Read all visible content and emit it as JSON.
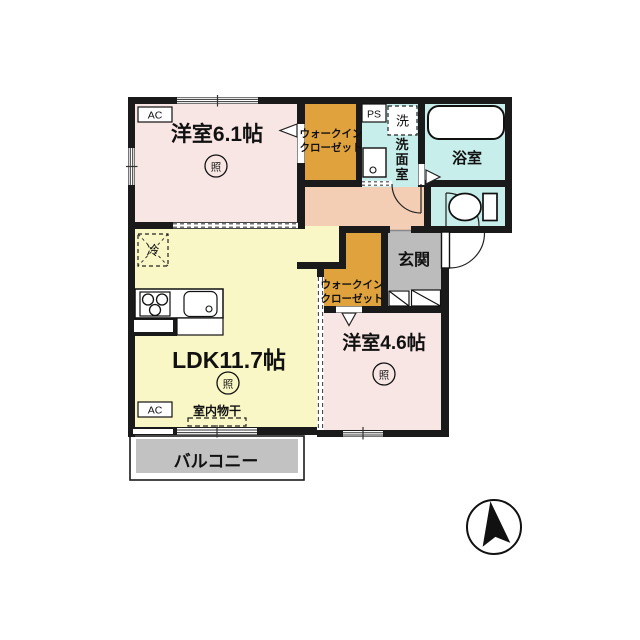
{
  "title": "apartment-floor-plan",
  "colors": {
    "wall": "#1a1a1a",
    "pink": "#f8e6e4",
    "yellow": "#faf7c6",
    "orange": "#dfa23c",
    "cyan": "#c8eeeb",
    "peach": "#f3ceb4",
    "entry_gray": "#bcbcbc",
    "balcony_gray": "#c2c2c2"
  },
  "rooms": {
    "bedroom1": {
      "label": "洋室6.1帖",
      "light": "照"
    },
    "ldk": {
      "label": "LDK11.7帖",
      "light": "照"
    },
    "bedroom2": {
      "label": "洋室4.6帖",
      "light": "照"
    },
    "wic1": {
      "line1": "ウォークイン",
      "line2": "クローゼット"
    },
    "wic2": {
      "line1": "ウォークイン",
      "line2": "クローゼット"
    },
    "washroom": {
      "char1": "洗",
      "char2": "面",
      "char3": "室"
    },
    "bath": {
      "label": "浴室"
    },
    "entrance": {
      "label": "玄関"
    },
    "balcony": {
      "label": "バルコニー"
    }
  },
  "equipment": {
    "ac": "AC",
    "ps": "PS",
    "fridge": "冷",
    "washer": "洗",
    "indoor_drying": "室内物干"
  }
}
